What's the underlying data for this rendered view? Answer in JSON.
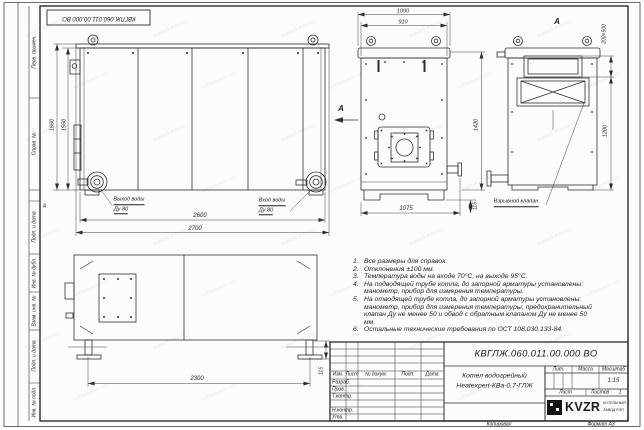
{
  "frame": {
    "top_stamp": "КВГЛЖ.060.011.00.000 ВО",
    "zone_letter": "А",
    "watermark": "kotlam-kvz.ru",
    "margin_top": [
      "Перв. примен.",
      "Справ. №"
    ],
    "margin_bottom": [
      "Подп. и дата",
      "Инв. № дубл.",
      "Взам. инв. №",
      "Подп. и дата",
      "Инв. № подл."
    ],
    "copied": "Копировал",
    "format": "Формат А3"
  },
  "views": {
    "front": {
      "dim_h_outer": "1660",
      "dim_h_inner": "1550",
      "dim_w_inner": "2600",
      "dim_w_outer": "2700",
      "outlet_label": "Выход воды",
      "outlet_dn": "Ду 80",
      "inlet_label": "Вход воды",
      "inlet_dn": "Ду 80"
    },
    "face": {
      "dim_w_outer": "1000",
      "dim_w_inner": "910",
      "dim_h": "1420",
      "dim_base": "1075",
      "dim_foot": "115",
      "section_mark": "А"
    },
    "rear": {
      "view_label": "А",
      "dim_opening": "200×500",
      "dim_h": "1200",
      "callout": "Взрывной клапан"
    },
    "bottom": {
      "dim_w": "2300",
      "dim_foot": "115"
    }
  },
  "notes": [
    {
      "n": "1.",
      "text": "Все размеры для справок."
    },
    {
      "n": "2.",
      "text": "Отклонения ±100 мм."
    },
    {
      "n": "3.",
      "text": "Температура воды на входе 70°С, на выходе 95°С."
    },
    {
      "n": "4.",
      "text": "На подводящей трубе котла, до запорной арматуры установлены: манометр, прибор для измерения температуры."
    },
    {
      "n": "5.",
      "text": "На отводящей трубе котла, до запорной арматуры установлены: манометр, прибор для измерения температуры, предохранительный клапан Ду не менее 50 и обвод с обратным клапаном Ду не менее 50 мм."
    },
    {
      "n": "6.",
      "text": "Остальные технические требования по ОСТ 108.030.133-84."
    }
  ],
  "title_block": {
    "doc_number": "КВГЛЖ.060.011.00.000 ВО",
    "product_line1": "Котел водогрейный",
    "product_line2": "Heatexpert-КВа-0,7-ГЛЖ",
    "col_izm": "Изм.",
    "col_list": "Лист",
    "col_doc": "№ докум.",
    "col_sign": "Подп.",
    "col_date": "Дата",
    "row_dev": "Разраб.",
    "row_check": "Пров.",
    "row_tcontr": "Т.контр.",
    "row_ncontr": "Н.контр.",
    "row_approve": "Утв.",
    "lit": "Лит.",
    "mass": "Масса",
    "scale": "Масштаб",
    "scale_value": "1:15",
    "sheet": "Лист",
    "sheets": "Листов",
    "sheets_value": "1",
    "logo": "KVZR",
    "logo_sub1": "КОТЕЛЬНЫЙ",
    "logo_sub2": "ЗАВОД РЭП"
  }
}
